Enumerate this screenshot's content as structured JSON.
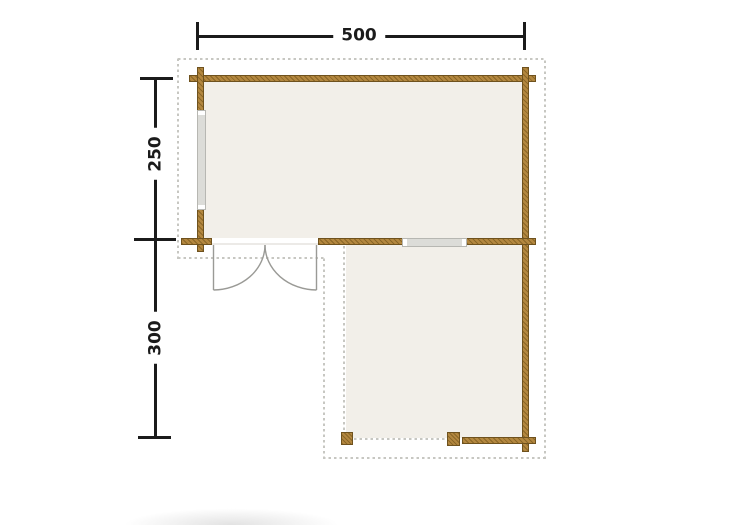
{
  "diagram": {
    "type": "floor-plan",
    "dimensions": {
      "width_label": "500",
      "upper_depth_label": "250",
      "lower_depth_label": "300"
    },
    "colors": {
      "wall": "#b3873f",
      "wall_border": "#6f521e",
      "floor": "#f2efe9",
      "glass": "#dcdcd8",
      "dash": "#c7c7c2",
      "dimension": "#1b1b1b",
      "door_swing": "#9a9a96"
    }
  }
}
